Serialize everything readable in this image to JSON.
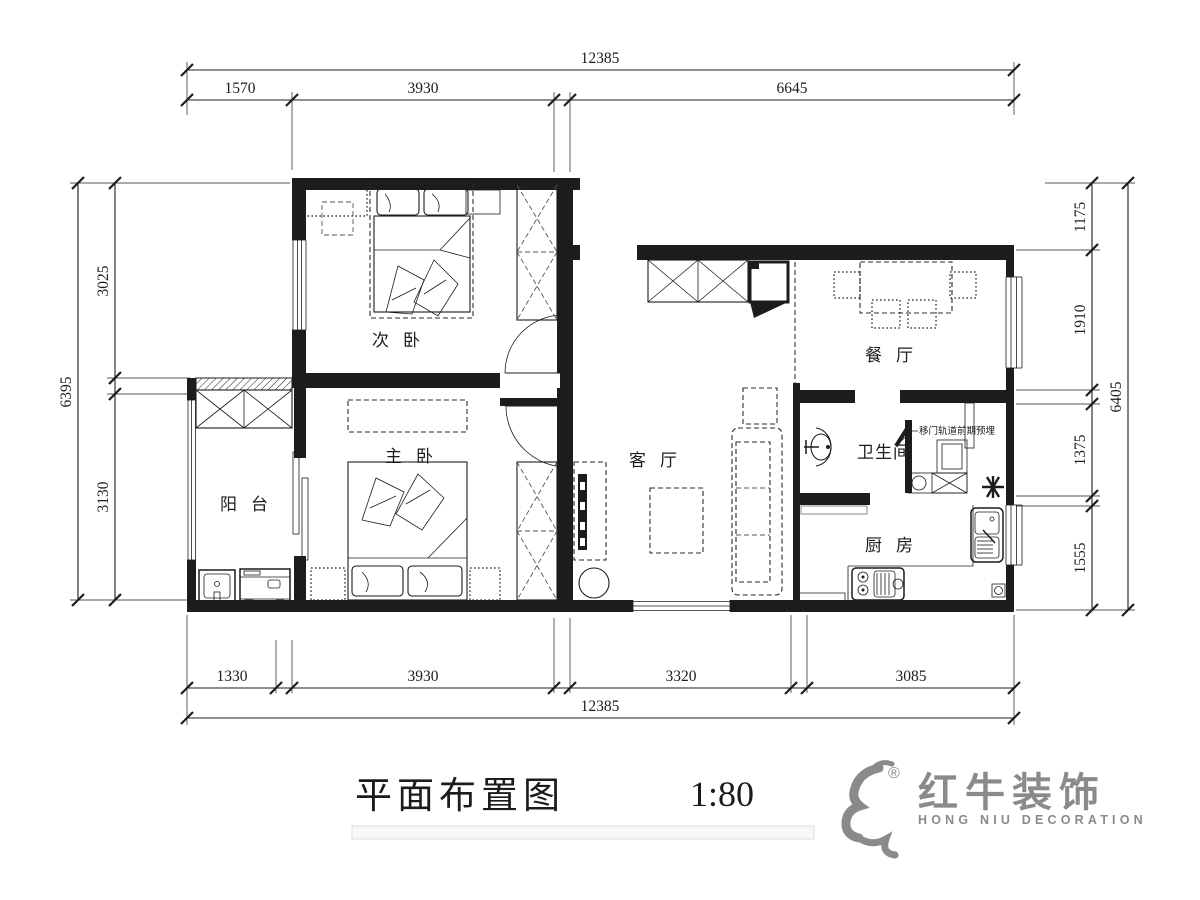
{
  "meta": {
    "drawing_title": "平面布置图",
    "scale_label": "1:80"
  },
  "logo": {
    "brand_cn": "红牛装饰",
    "brand_en": "HONG NIU DECORATION",
    "registered": "®"
  },
  "rooms": {
    "secondary_bedroom": "次卧",
    "master_bedroom": "主卧",
    "balcony": "阳台",
    "living_room": "客厅",
    "dining_room": "餐厅",
    "bathroom": "卫生间",
    "kitchen": "厨房"
  },
  "annotation": {
    "sliding_door_note": "移门轨道前期预埋"
  },
  "dimensions": {
    "top": {
      "total": "12385",
      "segments": [
        "1570",
        "3930",
        "6645"
      ]
    },
    "bottom": {
      "total": "12385",
      "segments": [
        "1330",
        "3930",
        "3320",
        "3085"
      ]
    },
    "left": {
      "total": "6395",
      "segments": [
        "3025",
        "3130"
      ]
    },
    "right": {
      "total": "6405",
      "segments": [
        "1175",
        "1910",
        "1375",
        "1555"
      ]
    }
  },
  "colors": {
    "line": "#1c1c1c",
    "logo_gray": "#8a8a8a",
    "title_bar": "#f8f8f8"
  }
}
